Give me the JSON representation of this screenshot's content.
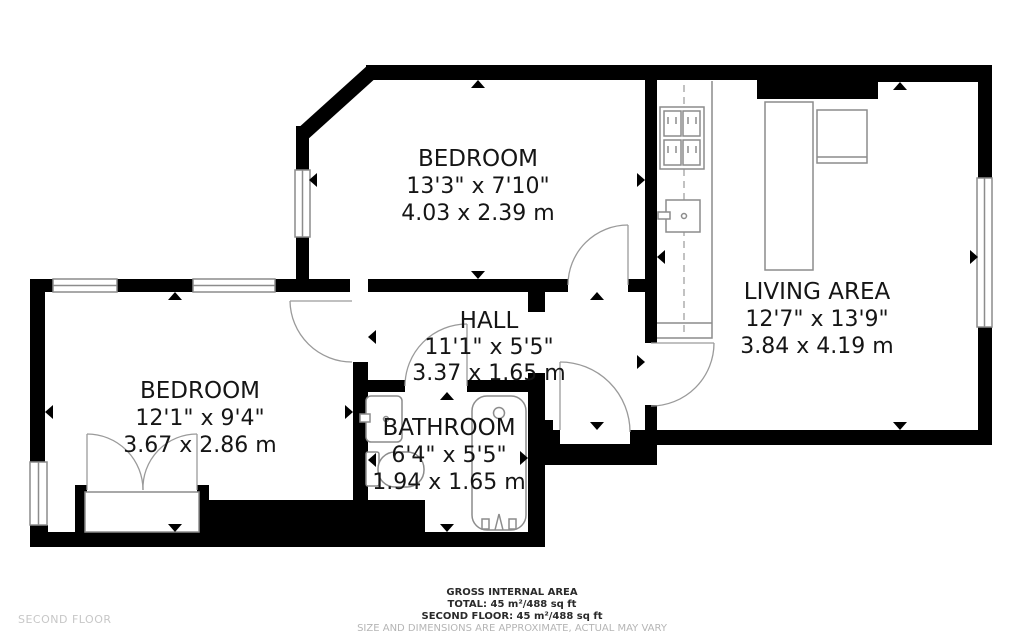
{
  "floorplan": {
    "floor_label": "SECOND FLOOR",
    "rooms": [
      {
        "name": "BEDROOM",
        "imperial": "13'3\" x 7'10\"",
        "metric": "4.03 x 2.39 m"
      },
      {
        "name": "LIVING AREA",
        "imperial": "12'7\" x 13'9\"",
        "metric": "3.84 x 4.19 m"
      },
      {
        "name": "HALL",
        "imperial": "11'1\" x 5'5\"",
        "metric": "3.37 x 1.65 m"
      },
      {
        "name": "BEDROOM",
        "imperial": "12'1\" x 9'4\"",
        "metric": "3.67 x 2.86 m"
      },
      {
        "name": "BATHROOM",
        "imperial": "6'4\" x 5'5\"",
        "metric": "1.94 x 1.65 m"
      }
    ],
    "footer": {
      "line1": "GROSS INTERNAL AREA",
      "line2": "TOTAL: 45 m²/488 sq ft",
      "line3": "SECOND FLOOR: 45 m²/488 sq ft",
      "disclaimer": "SIZE AND DIMENSIONS ARE APPROXIMATE, ACTUAL MAY VARY"
    },
    "colors": {
      "wall": "#000000",
      "line": "#8c8c8c",
      "text": "#151515",
      "muted": "#b5b5b5"
    }
  }
}
